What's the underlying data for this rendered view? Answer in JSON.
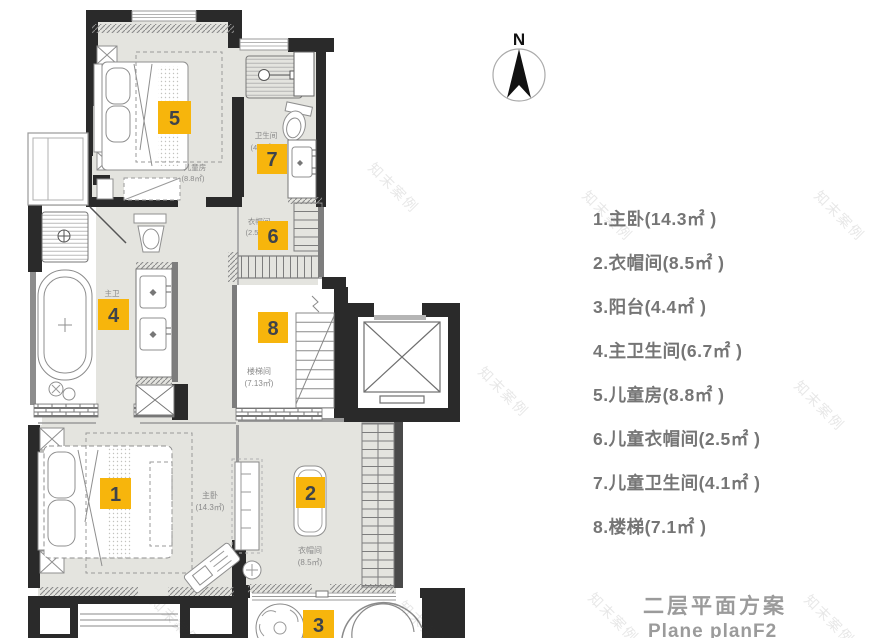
{
  "watermark": {
    "text": "知末案例"
  },
  "compass": {
    "label": "N"
  },
  "plan": {
    "rooms": {
      "room5": {
        "name": "儿童房",
        "area": "(8.8㎡)"
      },
      "room7": {
        "name": "卫生间",
        "area": "(4.1㎡)"
      },
      "room6": {
        "name": "衣帽间",
        "area": "(2.5㎡)"
      },
      "room8": {
        "name": "楼梯间",
        "area": "(7.13㎡)"
      },
      "room4": {
        "name": "主卫",
        "area": "(6.7㎡)"
      },
      "room1": {
        "name": "主卧",
        "area": "(14.3㎡)"
      },
      "room2": {
        "name": "衣帽间",
        "area": "(8.5㎡)"
      }
    },
    "markers": {
      "m1": "1",
      "m2": "2",
      "m3": "3",
      "m4": "4",
      "m5": "5",
      "m6": "6",
      "m7": "7",
      "m8": "8"
    }
  },
  "legend": {
    "items": [
      {
        "text": "1.主卧(14.3㎡ )"
      },
      {
        "text": "2.衣帽间(8.5㎡ )"
      },
      {
        "text": "3.阳台(4.4㎡ )"
      },
      {
        "text": "4.主卫生间(6.7㎡ )"
      },
      {
        "text": "5.儿童房(8.8㎡ )"
      },
      {
        "text": "6.儿童衣帽间(2.5㎡ )"
      },
      {
        "text": "7.儿童卫生间(4.1㎡ )"
      },
      {
        "text": "8.楼梯(7.1㎡ )"
      }
    ]
  },
  "title": {
    "zh": "二层平面方案",
    "en": "Plane planF2"
  },
  "colors": {
    "marker": "#F7B50C",
    "marker_text": "#3E434B",
    "floor": "#E4E4DF",
    "wall": "#2A2A2A"
  }
}
